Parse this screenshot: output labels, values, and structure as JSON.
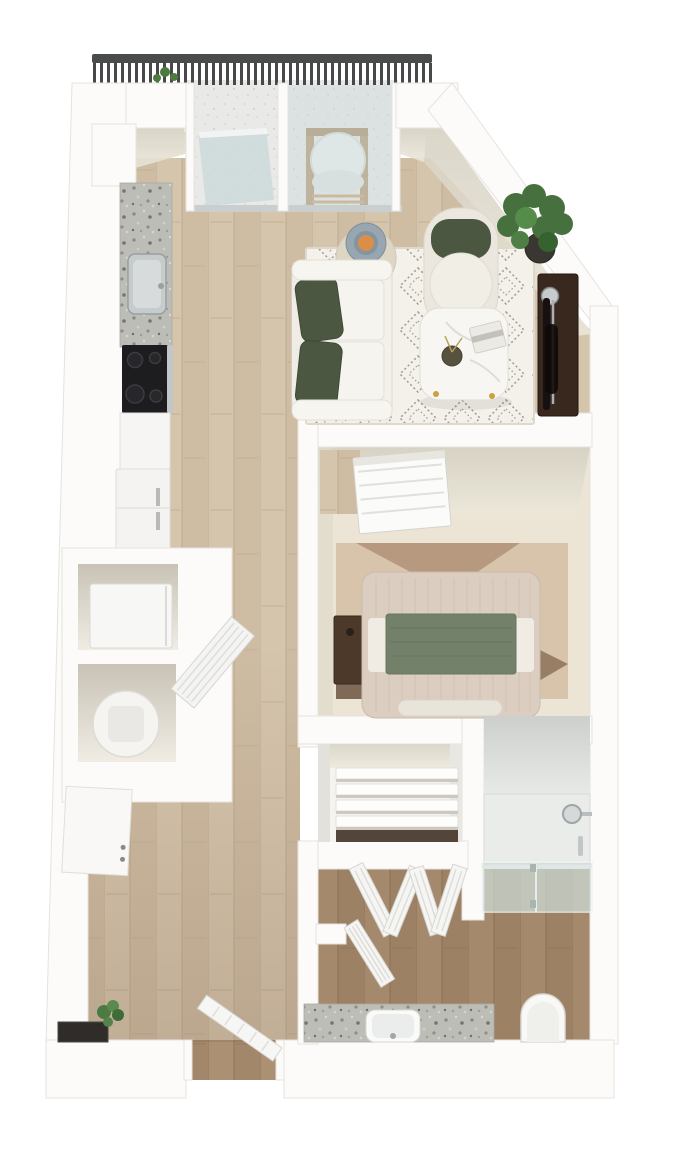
{
  "meta": {
    "title": "3D rendered apartment floor plan, top-down view",
    "style": "photoreal architectural rendering, no text labels"
  },
  "palette": {
    "background": "#ffffff",
    "wall": "#fcfbfa",
    "wall_face_warm": "#d5d0c2",
    "wood_light_base": "#d6c5ad",
    "wood_dark_base": "#a98e72",
    "bedroom_carpet": "#ece5d5",
    "granite": "#bdbdb7",
    "glass": "#ccd9db",
    "shower_glass": "#cfdeda",
    "sofa_cream": "#f3f1ec",
    "pillow_green": "#4b5741",
    "blanket_sage": "#73816b",
    "console_brown": "#38281e",
    "railing_dark": "#4a4c4b",
    "plant_green": "#47703f",
    "lamp_amber": "#d98f47",
    "rug_base": "#f4f1ea",
    "bedroom_rug": "#d8c4ab",
    "nightstand_wood": "#4c3929"
  },
  "scene": {
    "balcony": {
      "railing": "dark metal railing with vertical slats",
      "chair": "wooden chair with white round cushion seen through window",
      "plant": "small greenery at railing"
    },
    "living_room": {
      "items": [
        "sliding glass balcony door",
        "picture window",
        "cream sofa with two dark green pillows",
        "round side table with lit lamp",
        "accent tub chair with green back cushion",
        "diamond-pattern area rug",
        "white marble coffee table with book and vase",
        "potted plant in corner",
        "dark wood media console with flat tv"
      ]
    },
    "kitchen": {
      "items": [
        "granite countertop with stainless sink",
        "black cooktop with oven handle",
        "base cabinet",
        "white refrigerator"
      ]
    },
    "laundry_area": {
      "items": [
        "washer in closet",
        "round water heater in closet",
        "open louvered closet door",
        "white linen cabinet with two knobs"
      ]
    },
    "bedroom": {
      "items": [
        "white dresser on wood nook",
        "bed with striped duvet and sage green throw",
        "dark wood nightstand",
        "tan abstract area rug",
        "wall-to-wall carpet"
      ]
    },
    "walk_in_closet": {
      "items": [
        "white shelving stack",
        "two open bifold louvered doors"
      ]
    },
    "bathroom": {
      "items": [
        "walk-in shower with glass door and chrome shower head",
        "granite vanity with white sink",
        "toilet",
        "open louvered bathroom door"
      ]
    },
    "entry": {
      "items": [
        "open entry door at bottom doorway",
        "dark recessed mat niche in left wall",
        "small green plant"
      ]
    }
  }
}
